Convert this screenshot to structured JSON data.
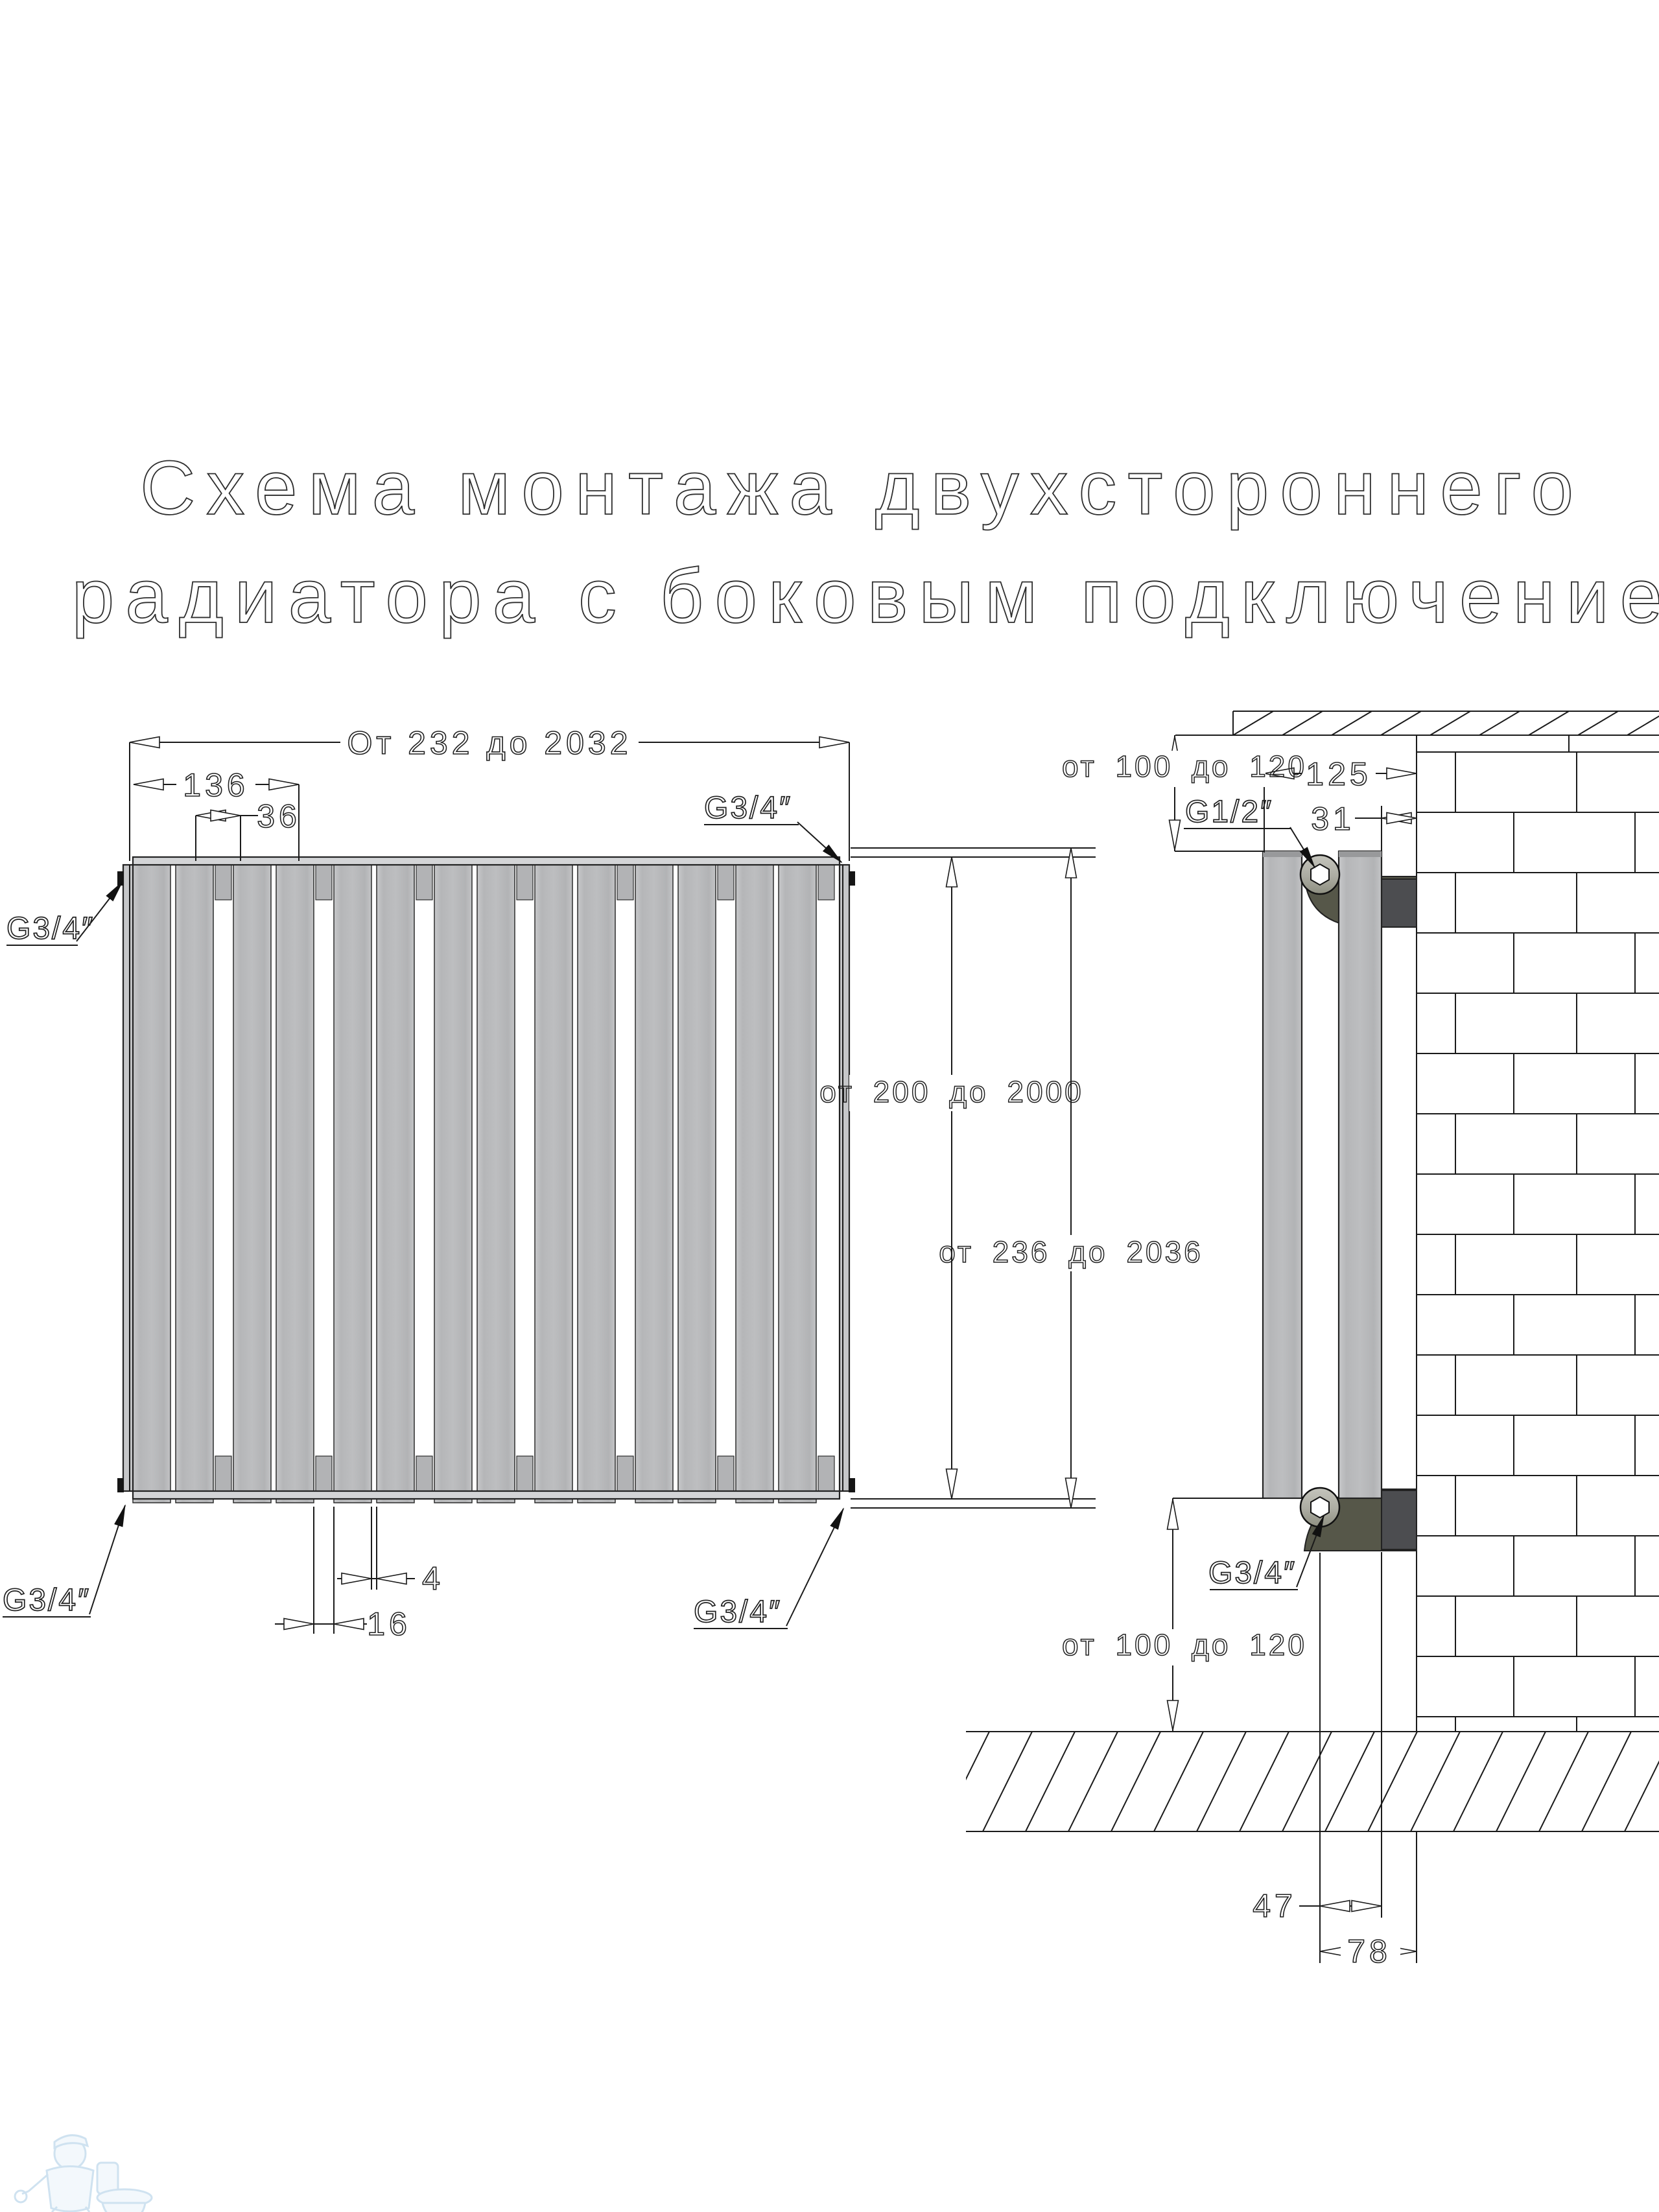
{
  "title": {
    "line1": "Схема монтажа двухстороннего",
    "line2": "радиатора с боковым подключением"
  },
  "front_view": {
    "dim_overall": "От 232 до 2032",
    "dim_136": "136",
    "dim_36": "36",
    "dim_16": "16",
    "dim_4": "4",
    "dim_height_inner": "от 200 до 2000",
    "dim_height_outer": "от 236 до 2036",
    "conn_top_left": "G3/4″",
    "conn_top_right": "G3/4″",
    "conn_bottom_left": "G3/4″",
    "conn_bottom_right": "G3/4″"
  },
  "side_view": {
    "dim_top_offset": "от 100 до 120",
    "dim_depth": "125",
    "dim_standoff": "31",
    "conn_top": "G1/2″",
    "conn_bottom": "G3/4″",
    "dim_bottom_offset": "от 100 до 120",
    "dim_47": "47",
    "dim_78": "78"
  },
  "colors": {
    "line": "#1a1a1a",
    "slat_gray": "#b9babc",
    "bracket_olive": "#565749",
    "bracket_gray": "#4c4d50",
    "watermark_blue": "#a8cbe4"
  }
}
